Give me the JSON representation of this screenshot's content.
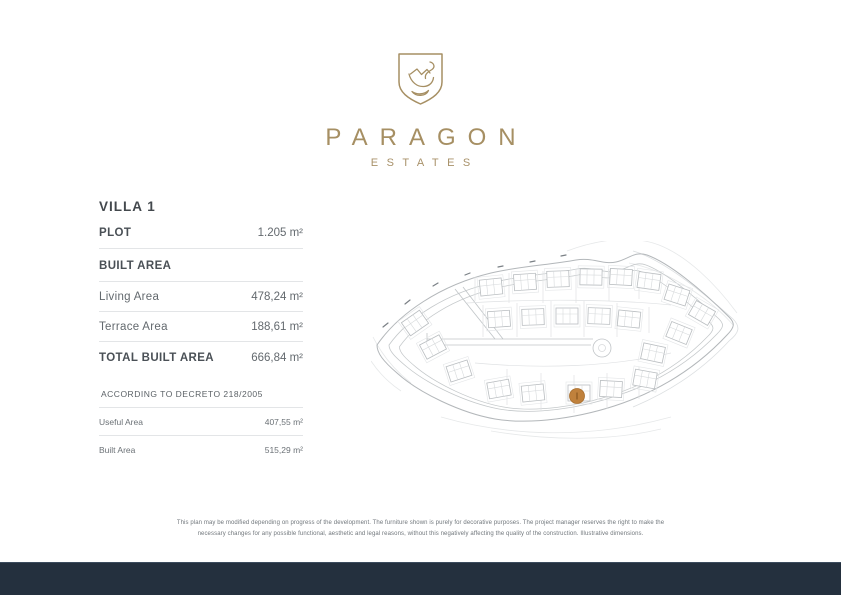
{
  "colors": {
    "gold": "#a68f63",
    "navy": "#24303e",
    "marker": "#c0813c",
    "marker_edge": "#a96f2e",
    "text_dark": "#4a5056",
    "text_muted": "#63696e"
  },
  "brand": {
    "name": "PARAGON",
    "tagline": "ESTATES",
    "logo": "swan-shield-icon"
  },
  "villa": {
    "title": "VILLA 1",
    "plot_label": "PLOT",
    "plot_value": "1.205 m²",
    "built_area_heading": "BUILT AREA",
    "rows": [
      {
        "label": "Living Area",
        "value": "478,24 m²"
      },
      {
        "label": "Terrace Area",
        "value": "188,61 m²"
      }
    ],
    "total_label": "TOTAL BUILT AREA",
    "total_value": "666,84 m²"
  },
  "decreto": {
    "heading": "ACCORDING TO DECRETO 218/2005",
    "rows": [
      {
        "label": "Useful Area",
        "value": "407,55 m²"
      },
      {
        "label": "Built Area",
        "value": "515,29 m²"
      }
    ]
  },
  "disclaimer": "This plan may be modified depending on progress of the development. The furniture shown is purely for decorative purposes. The project manager reserves the right to make the necessary changes for any possible functional, aesthetic and legal reasons, without this negatively affecting the quality of the construction. Illustrative dimensions."
}
